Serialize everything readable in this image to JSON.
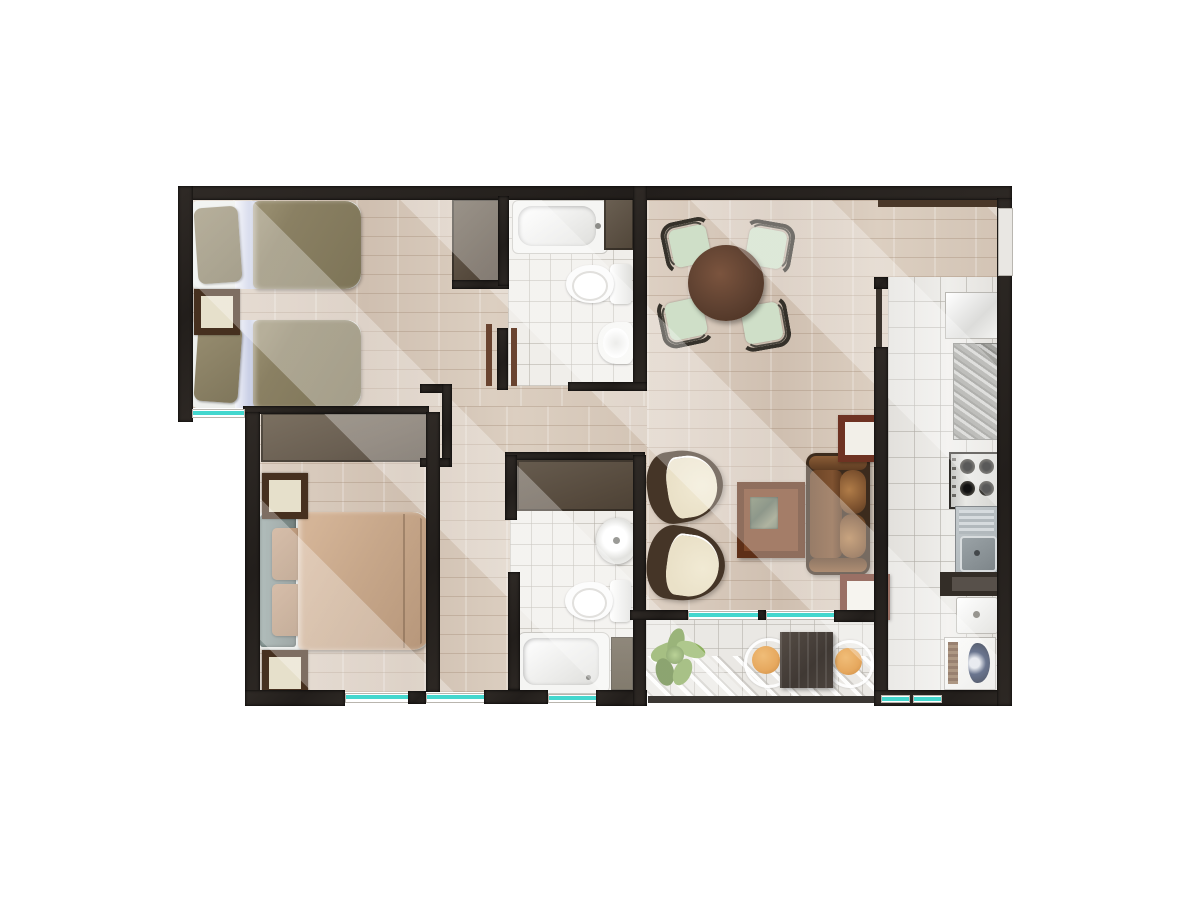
{
  "meta": {
    "title": "apartment-floor-plan-top-view",
    "style": "rendered-architectural-plan"
  },
  "palette": {
    "wall": "#2b2622",
    "glass": "#44d7ce",
    "tile_bath": "#f0eeea",
    "tile_balcony": "#eae8e4",
    "door_leaf": "#6a4430",
    "nstand_top": "#e6e0cb",
    "nstand_frame": "#46301f",
    "side_table": "#6e3222",
    "dining_chair": "#cfdfc8",
    "armchair_seat": "#eae1c8",
    "armchair_frame": "#453527",
    "bed_twin": "#8a8063",
    "bed_double": "#c7a78a",
    "headboard": "#7e8f8d",
    "wardrobe_gray": "#75695b",
    "closet_brown": "#5d5348",
    "dining_table": "#5d4030",
    "coffee_table": "#6e3a20",
    "sofa_leather": "#7c512e",
    "granite": "#a3a39f",
    "steel": "#b7bdc0",
    "washer_navy": "#2a3a5e",
    "balcony_chair": "#e6a85e",
    "plant_green": "#6f9440",
    "top_ledge_brown": "#4a3829"
  },
  "rooms": {
    "bedroom1": "bedroom-1 twin beds",
    "bedroom2": "bedroom-2 double bed",
    "bathroom1": "bathroom-1 tub toilet bidet",
    "bathroom2": "bathroom-2 tub toilet sink",
    "kitchen": "kitchen and laundry strip",
    "living": "living and dining room",
    "balcony": "balcony terrace",
    "hallway": "hallway"
  },
  "furniture": {
    "twin_bed_1": "twin bed",
    "twin_bed_2": "twin bed",
    "double_bed": "double bed",
    "nightstand": "nightstand",
    "wardrobe": "wardrobe",
    "bathtub": "bathtub",
    "toilet": "toilet",
    "bidet": "bidet",
    "basin": "wash basin",
    "dining_table": "round dining table",
    "dining_chair": "dining chair",
    "armchair": "armchair",
    "coffee_table": "coffee table",
    "sofa": "leather sofa",
    "side_table": "side table",
    "fridge": "refrigerator",
    "granite_counter": "granite counter",
    "stove": "4-burner stove",
    "kitchen_sink": "stainless sink",
    "laundry_sink": "laundry sink",
    "washer": "washing machine",
    "balcony_table": "balcony table",
    "balcony_chair": "balcony chair",
    "plant": "potted plant",
    "window": "window glazing",
    "door": "open door leaf"
  }
}
